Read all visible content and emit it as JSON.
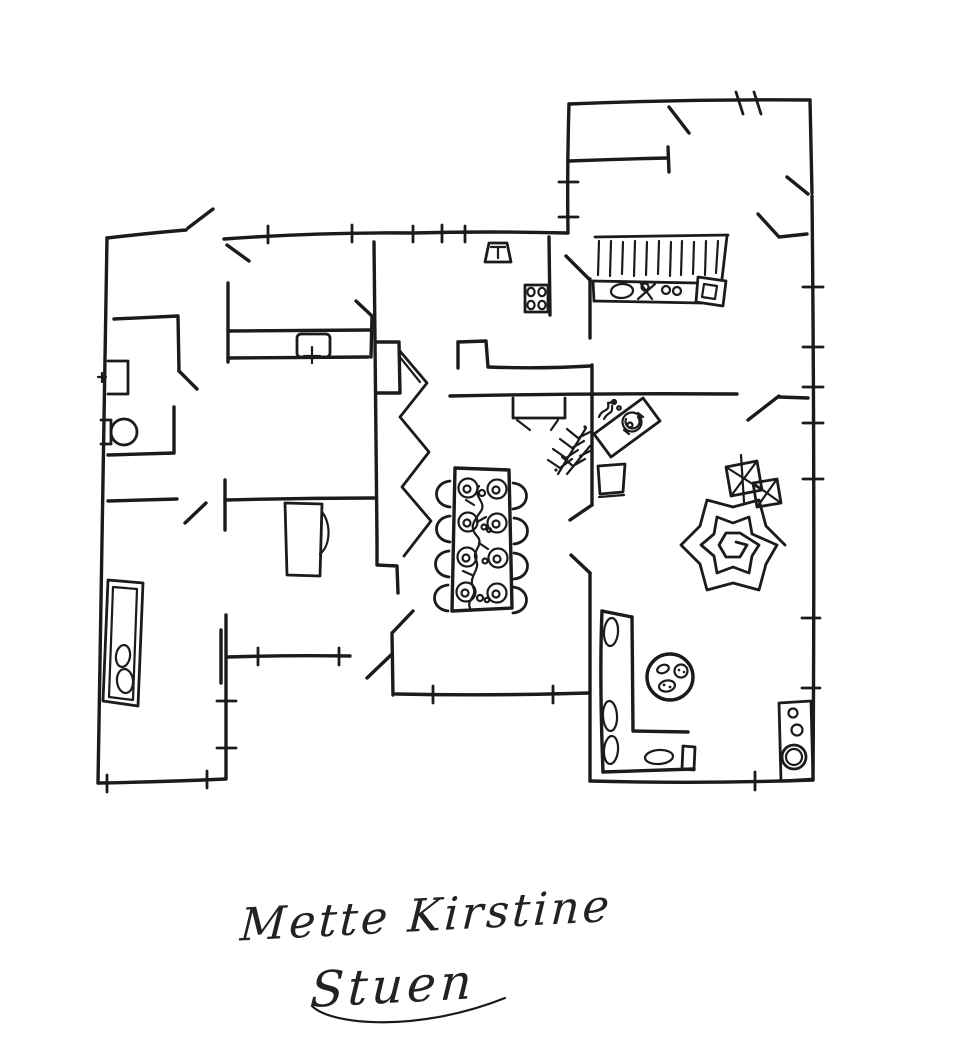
{
  "canvas": {
    "width": 960,
    "height": 1061,
    "background": "#ffffff",
    "ink": "#1b1b1b"
  },
  "caption": {
    "line1": "Mette Kirstine",
    "line2": "Stuen"
  },
  "sketch": {
    "kind": "hand-drawn ink floor plan",
    "objects": [
      {
        "name": "bed",
        "location": "bottom-left room"
      },
      {
        "name": "toilet",
        "location": "left bathroom"
      },
      {
        "name": "washbasin",
        "location": "left bathroom"
      },
      {
        "name": "hall-cabinet",
        "location": "hallway"
      },
      {
        "name": "wardrobe-closet",
        "location": "center-left room"
      },
      {
        "name": "staircase",
        "location": "center hallway"
      },
      {
        "name": "dining-table",
        "place_settings": 8,
        "chairs": 8,
        "location": "center"
      },
      {
        "name": "kitchen-counter-with-sink",
        "location": "top-right kitchen"
      },
      {
        "name": "stove",
        "burners": 4,
        "location": "kitchen"
      },
      {
        "name": "small-sink-unit",
        "location": "kitchen wall"
      },
      {
        "name": "potted-plant",
        "location": "center"
      },
      {
        "name": "plant-pot",
        "location": "center"
      },
      {
        "name": "desk-with-chair",
        "location": "center-right"
      },
      {
        "name": "rug",
        "location": "living room"
      },
      {
        "name": "stools",
        "count": 2,
        "location": "living room"
      },
      {
        "name": "corner-sofa",
        "location": "bottom-right living room"
      },
      {
        "name": "coffee-table",
        "location": "living room"
      },
      {
        "name": "stereo-cabinet",
        "location": "living room east wall"
      }
    ]
  }
}
